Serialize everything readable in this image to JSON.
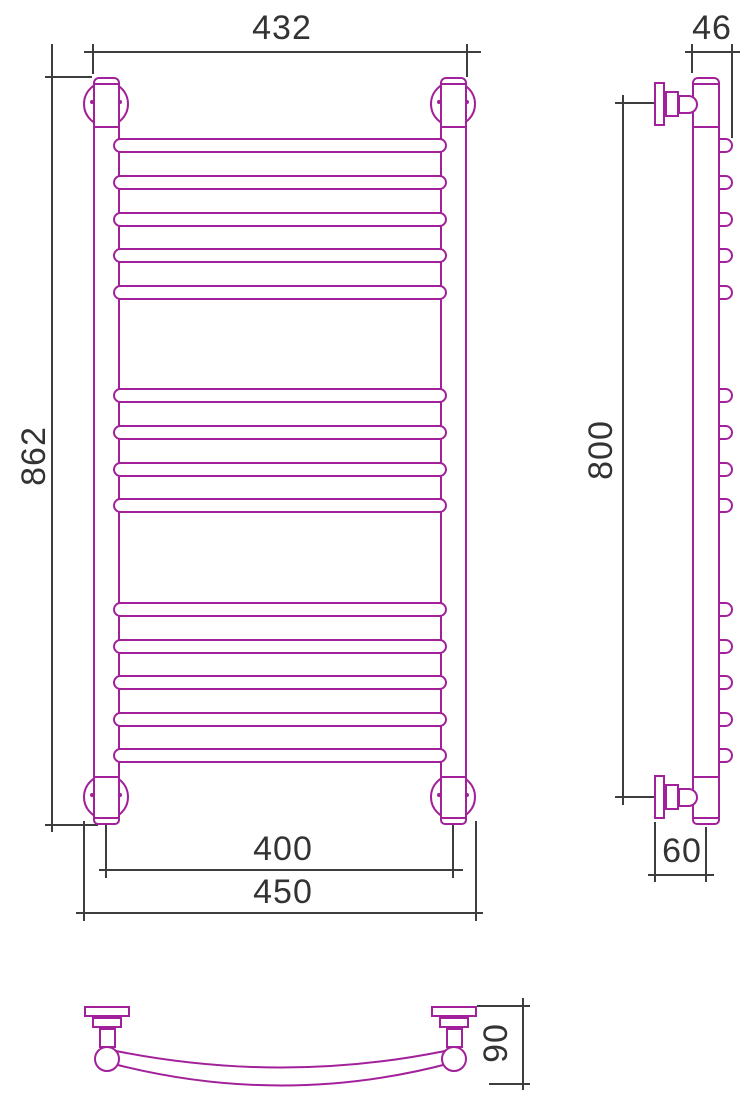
{
  "drawing": {
    "type": "technical-drawing-towel-rail",
    "colors": {
      "product_line": "#a2219a",
      "dimension_line": "#3d3d3d",
      "label_text": "#333333",
      "background": "#ffffff"
    },
    "dimensions": {
      "front_top_width": "432",
      "front_total_height": "862",
      "front_pin_spacing": "400",
      "front_bottom_width": "450",
      "side_top_depth": "46",
      "side_mount_height": "800",
      "side_wall_offset": "60",
      "top_view_depth": "90"
    },
    "rungs": {
      "height": 15,
      "groups": [
        {
          "count": 5,
          "start_y": 138,
          "pitch": 36.75
        },
        {
          "count": 4,
          "start_y": 388,
          "pitch": 36.75
        },
        {
          "count": 5,
          "start_y": 602,
          "pitch": 36.5
        }
      ]
    }
  }
}
